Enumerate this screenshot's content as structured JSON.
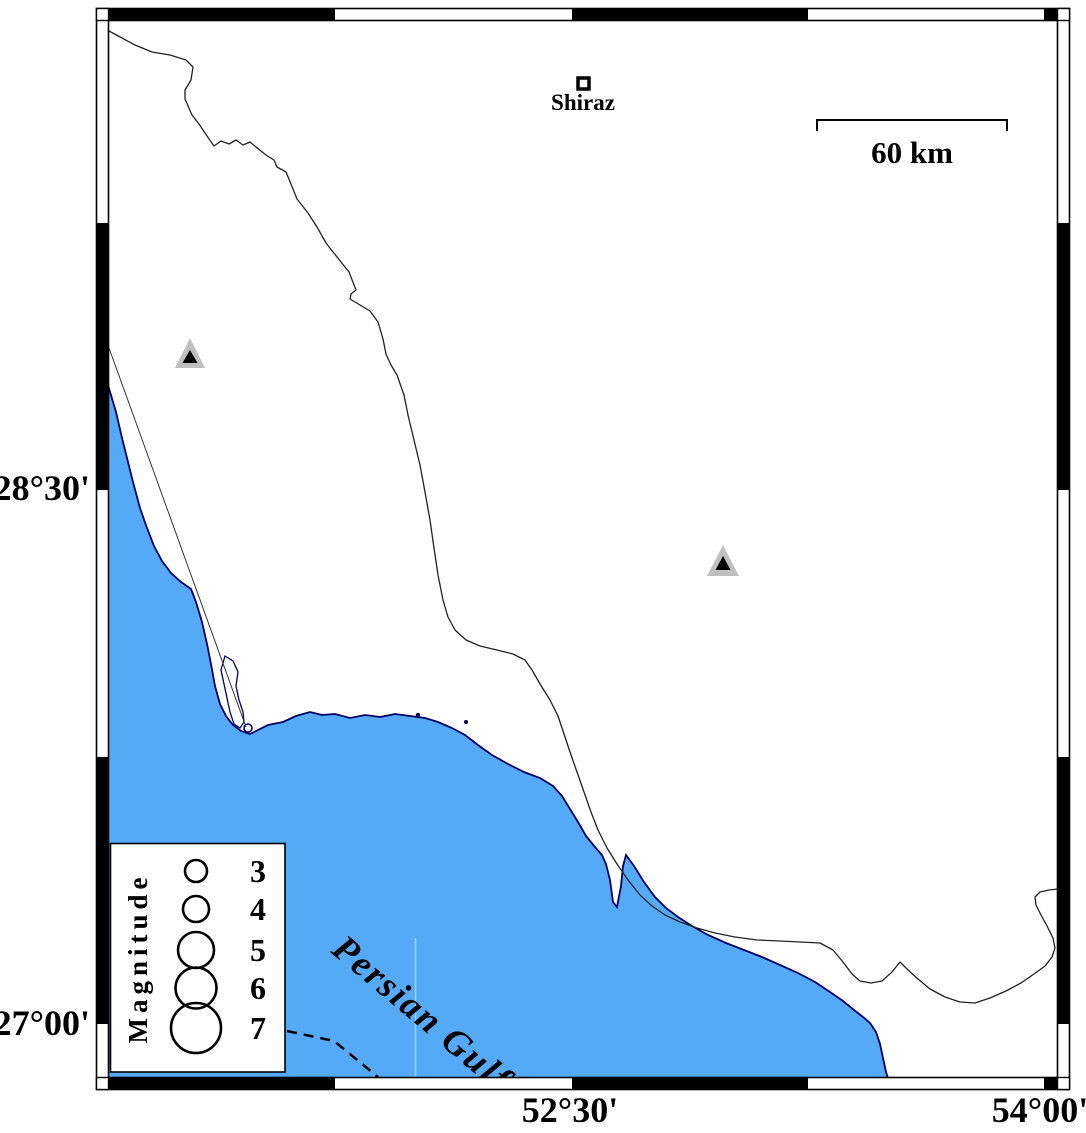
{
  "map": {
    "city": "Shiraz",
    "scalebar_label": "60 km",
    "sea_label": "Persian Gulf"
  },
  "axis": {
    "left": [
      "28°30'",
      "27°00'"
    ],
    "bottom": [
      "52°30'",
      "54°00'"
    ]
  },
  "legend": {
    "title": "Magnitude",
    "magnitudes": [
      "3",
      "4",
      "5",
      "6",
      "7"
    ]
  },
  "colors": {
    "sea": "#55aaf8",
    "coast_outline": "#000066",
    "station_fill": "#c0c0c0",
    "station_core": "#000000"
  }
}
